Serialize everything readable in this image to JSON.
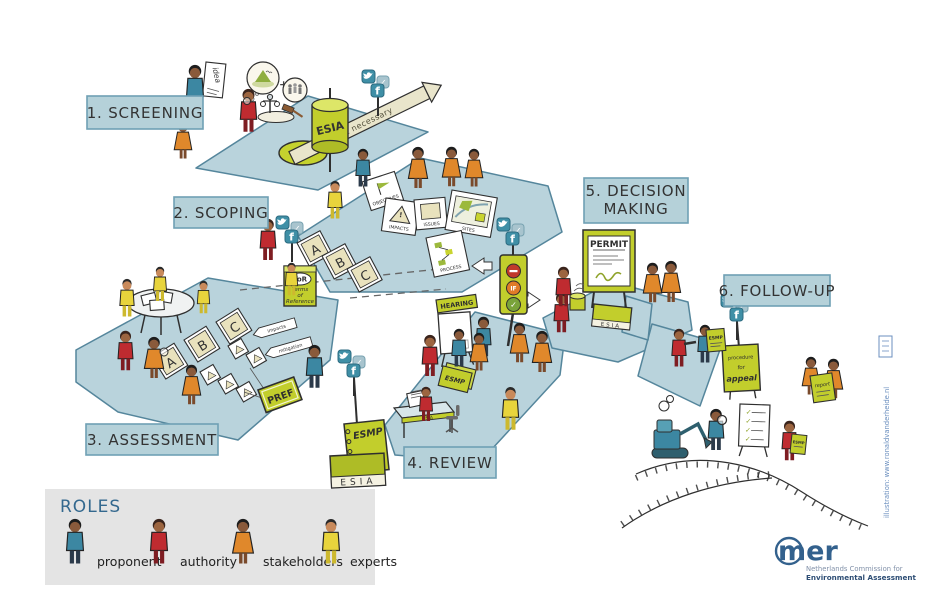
{
  "stages": {
    "screening": "1. SCREENING",
    "scoping": "2. SCOPING",
    "assessment": "3. ASSESSMENT",
    "review": "4. REVIEW",
    "decision_line1": "5. DECISION",
    "decision_line2": "MAKING",
    "followup": "6. FOLLOW-UP"
  },
  "screening_items": {
    "idea": "idea",
    "esia": "ESIA",
    "not_necessary": "not necessary",
    "plus": "+"
  },
  "scoping_items": {
    "card_a": "A",
    "card_b": "B",
    "card_c": "C",
    "paper_objectives": "OBJECTIVES",
    "paper_impacts": "IMPACTS",
    "paper_issues": "ISSUES",
    "paper_sites": "SITES",
    "paper_process": "PROCESS",
    "tor": "ToR",
    "tor_line1": "Terms",
    "tor_line2": "of",
    "tor_line3": "Reference"
  },
  "assessment_items": {
    "card_a": "A",
    "card_b": "B",
    "card_c": "C",
    "ribbon_impacts": "impacts",
    "ribbon_mitigation": "mitigation",
    "pref": "PREF"
  },
  "review_items": {
    "hearing": "HEARING",
    "esmp": "ESMP",
    "esia": "ESIA"
  },
  "decision_items": {
    "permit": "PERMIT",
    "traffic_if": "IF",
    "esia": "ESIA"
  },
  "followup_items": {
    "appeal_line1": "procedure",
    "appeal_line2": "for",
    "appeal_line3": "appeal",
    "report": "report",
    "esmp": "ESMP"
  },
  "legend": {
    "title": "ROLES",
    "roles": [
      {
        "label": "proponent",
        "color": "#3c87a2"
      },
      {
        "label": "authority",
        "color": "#bf2b30"
      },
      {
        "label": "stakeholders",
        "color": "#e0882b"
      },
      {
        "label": "experts",
        "color": "#e8d43c"
      }
    ]
  },
  "logo": {
    "name": "mer",
    "line1": "Netherlands Commission for",
    "line2": "Environmental Assessment"
  },
  "credit": "illustration: www.ronaldvanderheide.nl",
  "colors": {
    "platform": "#b9d3dc",
    "platform_border": "#55869c",
    "label_bg": "#b5d1d9",
    "label_border": "#6fa0b4",
    "green": "#c2ce2c",
    "icon_teal": "#3f8fa6",
    "logo_blue": "#33618d"
  }
}
